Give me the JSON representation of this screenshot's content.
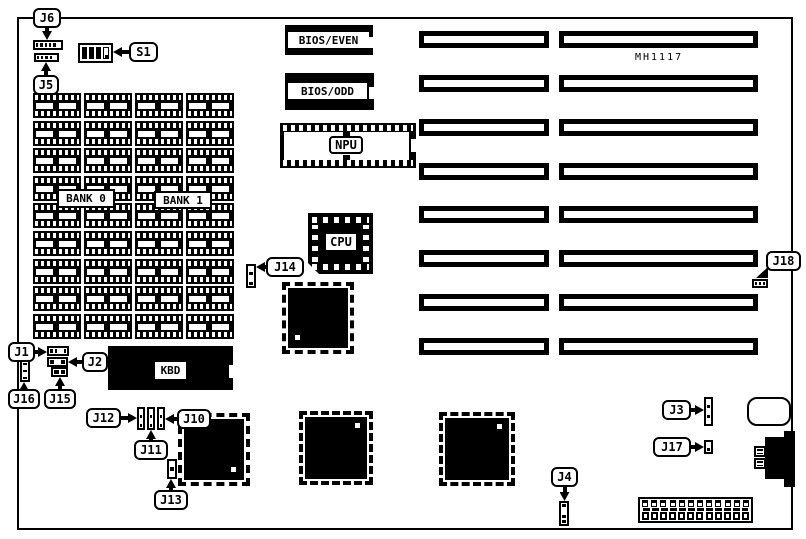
{
  "labels": {
    "bios_even": "BIOS/EVEN",
    "bios_odd": "BIOS/ODD",
    "npu": "NPU",
    "cpu": "CPU",
    "kbd": "KBD",
    "bank0": "BANK 0",
    "bank1": "BANK 1",
    "mh1117": "MH1117"
  },
  "colors": {
    "line": "#000000",
    "background": "#ffffff"
  },
  "board": {
    "x": 17,
    "y": 17,
    "w": 776,
    "h": 513
  },
  "memory": {
    "x0": 33,
    "y0": 93,
    "cols": 4,
    "rows": 9,
    "col_pitch": 51,
    "row_pitch": 27.6,
    "chip_w": 48,
    "chip_h": 25
  },
  "slots": {
    "row_y": [
      31,
      75,
      119,
      163,
      206,
      250,
      294,
      338
    ],
    "left": {
      "x": 419,
      "w": 130
    },
    "right": {
      "x": 559,
      "w": 199
    },
    "h": 17
  },
  "qfps": [
    {
      "name": "qfp-chip-1",
      "x": 288,
      "y": 288,
      "w": 60,
      "h": 60,
      "dot": "bl"
    },
    {
      "name": "qfp-chip-2",
      "x": 184,
      "y": 419,
      "w": 60,
      "h": 61,
      "dot": "br"
    },
    {
      "name": "qfp-chip-3",
      "x": 305,
      "y": 417,
      "w": 62,
      "h": 62,
      "dot": "tr"
    },
    {
      "name": "qfp-chip-4",
      "x": 445,
      "y": 418,
      "w": 64,
      "h": 62,
      "dot": "tr"
    }
  ],
  "connectors": [
    {
      "name": "connector-j6",
      "x": 33,
      "y": 40,
      "w": 30,
      "h": 10,
      "orient": "h",
      "cells": [
        "b",
        "b",
        "b",
        "b",
        "b",
        "w"
      ]
    },
    {
      "name": "connector-j5",
      "x": 34,
      "y": 53,
      "w": 25,
      "h": 9,
      "orient": "h",
      "cells": [
        "b",
        "b",
        "b",
        "b",
        "w"
      ]
    },
    {
      "name": "connector-j14",
      "x": 246,
      "y": 264,
      "w": 10,
      "h": 24,
      "orient": "v",
      "cells": [
        "w",
        "b",
        "w",
        "b"
      ]
    },
    {
      "name": "connector-j18",
      "x": 752,
      "y": 279,
      "w": 16,
      "h": 9,
      "orient": "h",
      "cells": [
        "b",
        "b",
        "b"
      ]
    },
    {
      "name": "connector-j1",
      "x": 47,
      "y": 346,
      "w": 22,
      "h": 10,
      "orient": "h",
      "cells": [
        "b",
        "b",
        "w",
        "b"
      ]
    },
    {
      "name": "connector-j2",
      "x": 47,
      "y": 357,
      "w": 21,
      "h": 10,
      "orient": "h",
      "cells": [
        "b",
        "w",
        "b"
      ]
    },
    {
      "name": "connector-j15",
      "x": 51,
      "y": 367,
      "w": 17,
      "h": 10,
      "orient": "h",
      "cells": [
        "b",
        "b"
      ]
    },
    {
      "name": "connector-j16",
      "x": 20,
      "y": 360,
      "w": 10,
      "h": 22,
      "orient": "v",
      "cells": [
        "b",
        "w",
        "b",
        "w",
        "b"
      ]
    },
    {
      "name": "connector-j12-1",
      "x": 137,
      "y": 407,
      "w": 8,
      "h": 23,
      "orient": "v",
      "cells": [
        "w",
        "b",
        "w",
        "b"
      ]
    },
    {
      "name": "connector-j12-2",
      "x": 147,
      "y": 407,
      "w": 8,
      "h": 23,
      "orient": "v",
      "cells": [
        "w",
        "b",
        "w",
        "b"
      ]
    },
    {
      "name": "connector-j12-3",
      "x": 157,
      "y": 407,
      "w": 8,
      "h": 23,
      "orient": "v",
      "cells": [
        "w",
        "b",
        "w",
        "b"
      ]
    },
    {
      "name": "connector-j13",
      "x": 167,
      "y": 459,
      "w": 10,
      "h": 20,
      "orient": "v",
      "cells": [
        "w",
        "b",
        "w"
      ]
    },
    {
      "name": "connector-j3",
      "x": 704,
      "y": 397,
      "w": 9,
      "h": 29,
      "orient": "v",
      "cells": [
        "w",
        "b",
        "w",
        "b",
        "w"
      ]
    },
    {
      "name": "connector-j17",
      "x": 704,
      "y": 440,
      "w": 9,
      "h": 14,
      "orient": "v",
      "cells": [
        "w",
        "b"
      ]
    },
    {
      "name": "connector-j4",
      "x": 559,
      "y": 501,
      "w": 10,
      "h": 25,
      "orient": "v",
      "cells": [
        "b",
        "w",
        "b",
        "b"
      ]
    },
    {
      "name": "connector-din-plug-1",
      "x": 754,
      "y": 446,
      "w": 12,
      "h": 11,
      "orient": "v",
      "cells": [
        "b",
        "b"
      ]
    },
    {
      "name": "connector-din-plug-2",
      "x": 754,
      "y": 458,
      "w": 12,
      "h": 11,
      "orient": "v",
      "cells": [
        "b",
        "b"
      ]
    }
  ],
  "callouts": [
    {
      "name": "callout-j6",
      "label": "J6",
      "x": 33,
      "y": 8,
      "w": 28,
      "dir": "down",
      "stem": 12
    },
    {
      "name": "callout-j5",
      "label": "J5",
      "x": 33,
      "y": 75,
      "w": 26,
      "dir": "up",
      "stem": 13
    },
    {
      "name": "callout-s1",
      "label": "S1",
      "x": 129,
      "y": 42,
      "w": 29,
      "dir": "left",
      "stem": 16
    },
    {
      "name": "callout-j14",
      "label": "J14",
      "x": 266,
      "y": 257,
      "w": 38,
      "dir": "left",
      "stem": 10
    },
    {
      "name": "callout-j18",
      "label": "J18",
      "x": 766,
      "y": 251,
      "w": 35,
      "dir": "downleft",
      "stem": 0
    },
    {
      "name": "callout-j1",
      "label": "J1",
      "x": 8,
      "y": 342,
      "w": 27,
      "dir": "right",
      "stem": 12
    },
    {
      "name": "callout-j2",
      "label": "J2",
      "x": 82,
      "y": 352,
      "w": 26,
      "dir": "left",
      "stem": 14
    },
    {
      "name": "callout-j16",
      "label": "J16",
      "x": 8,
      "y": 389,
      "w": 32,
      "dir": "up",
      "stem": 7
    },
    {
      "name": "callout-j15",
      "label": "J15",
      "x": 44,
      "y": 389,
      "w": 32,
      "dir": "up",
      "stem": 12
    },
    {
      "name": "callout-j12",
      "label": "J12",
      "x": 86,
      "y": 408,
      "w": 35,
      "dir": "right",
      "stem": 16
    },
    {
      "name": "callout-j10",
      "label": "J10",
      "x": 177,
      "y": 409,
      "w": 34,
      "dir": "left",
      "stem": 12
    },
    {
      "name": "callout-j11",
      "label": "J11",
      "x": 134,
      "y": 440,
      "w": 34,
      "dir": "up",
      "stem": 10
    },
    {
      "name": "callout-j13",
      "label": "J13",
      "x": 154,
      "y": 490,
      "w": 34,
      "dir": "up",
      "stem": 11
    },
    {
      "name": "callout-j3",
      "label": "J3",
      "x": 662,
      "y": 400,
      "w": 29,
      "dir": "right",
      "stem": 13
    },
    {
      "name": "callout-j17",
      "label": "J17",
      "x": 653,
      "y": 437,
      "w": 38,
      "dir": "right",
      "stem": 13
    },
    {
      "name": "callout-j4",
      "label": "J4",
      "x": 551,
      "y": 467,
      "w": 27,
      "dir": "down",
      "stem": 14
    }
  ],
  "power": {
    "x": 638,
    "y": 497,
    "w": 115,
    "h": 26,
    "pins": 12,
    "cells": 12
  }
}
